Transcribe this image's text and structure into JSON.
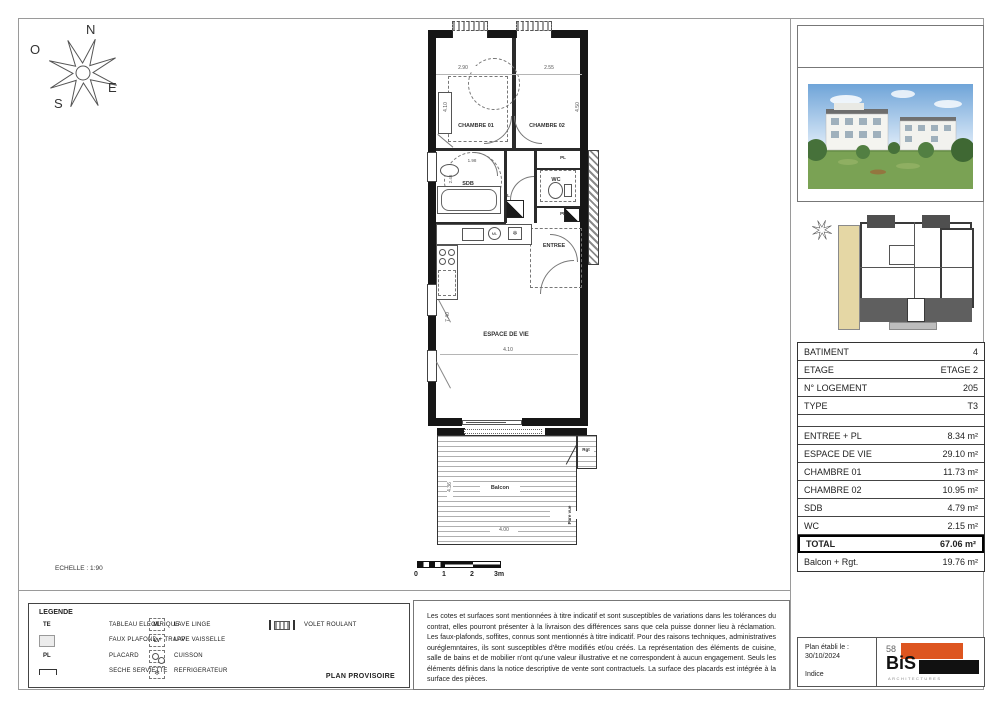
{
  "compass": {
    "north": "N",
    "west": "O",
    "east": "E",
    "south": "S"
  },
  "plan": {
    "scale_text": "ECHELLE : 1:90",
    "scale_bar_labels": [
      "0",
      "1",
      "2",
      "3m"
    ],
    "rooms": {
      "chambre01": "CHAMBRE 01",
      "chambre02": "CHAMBRE 02",
      "sdb": "SDB",
      "wc": "WC",
      "entree": "ENTREE",
      "espace_de_vie": "ESPACE DE VIE",
      "balcon": "Balcon",
      "rgt": "Rgt",
      "pare_vue": "Pare vue",
      "pl": "PL",
      "ml": "ML"
    },
    "dimensions": {
      "top_left": "2.90",
      "top_right": "2.55",
      "ch1_height": "4.10",
      "ch2_height": "4.50",
      "sdb_width": "1.98",
      "sdb_height": "2.46",
      "vie_height": "7.40",
      "vie_width": "4.10",
      "balcon_width": "4.00",
      "balcon_height": "4.36"
    }
  },
  "info_table": {
    "rows": [
      {
        "label": "BATIMENT",
        "value": "4"
      },
      {
        "label": "ETAGE",
        "value": "ETAGE 2"
      },
      {
        "label": "N° LOGEMENT",
        "value": "205"
      },
      {
        "label": "TYPE",
        "value": "T3"
      },
      {
        "label": "",
        "value": ""
      },
      {
        "label": "ENTREE + PL",
        "value": "8.34 m²"
      },
      {
        "label": "ESPACE DE VIE",
        "value": "29.10 m²"
      },
      {
        "label": "CHAMBRE 01",
        "value": "11.73 m²"
      },
      {
        "label": "CHAMBRE 02",
        "value": "10.95 m²"
      },
      {
        "label": "SDB",
        "value": "4.79 m²"
      },
      {
        "label": "WC",
        "value": "2.15 m²"
      },
      {
        "label": "TOTAL",
        "value": "67.06 m²"
      },
      {
        "label": "Balcon + Rgt.",
        "value": "19.76 m²"
      }
    ]
  },
  "legend": {
    "title": "LEGENDE",
    "col1": [
      {
        "symbol": "TE",
        "label": "TABLEAU ELECTRIQUE"
      },
      {
        "symbol": "",
        "label": "FAUX PLAFOND + TRAPPE"
      },
      {
        "symbol": "PL",
        "label": "PLACARD"
      },
      {
        "symbol": "",
        "label": "SECHE SERVIETTE"
      }
    ],
    "col2": [
      {
        "symbol": "ML",
        "label": "LAVE LINGE"
      },
      {
        "symbol": "LV",
        "label": "LAVE VAISSELLE"
      },
      {
        "symbol": "",
        "label": "CUISSON"
      },
      {
        "symbol": "",
        "label": "REFRIGERATEUR"
      }
    ],
    "col3": [
      {
        "symbol": "",
        "label": "VOLET ROULANT"
      }
    ],
    "plan_provisoire": "PLAN PROVISOIRE"
  },
  "notes": "Les cotes et surfaces sont mentionnées à titre indicatif et sont susceptibles de variations dans les tolérances du contrat, elles pourront présenter à la livraison des différences sans que cela puisse donner lieu à réclamation. Les faux-plafonds, soffites, connus sont mentionnés à titre indicatif. Pour des raisons techniques, administratives ouréglemntaires, ils sont susceptibles d'être modifiés et/ou créés. La représentation des éléments de cuisine, salle de bains et de mobilier n'ont qu'une valeur illustrative et ne correspondent à aucun engagement. Seuls les éléments définis dans la notice descriptive de vente sont contractuels. La surface des placards est intégrée à la surface des pièces.",
  "footer": {
    "date_label": "Plan établi le :",
    "date": "30/10/2024",
    "indice_label": "Indice",
    "logo_number": "58",
    "logo_text": "BiS",
    "logo_sub": "ARCHITECTURES"
  },
  "colors": {
    "accent_orange": "#DD5520",
    "logo_black": "#111111",
    "site_highlight": "#E5D7A5"
  }
}
